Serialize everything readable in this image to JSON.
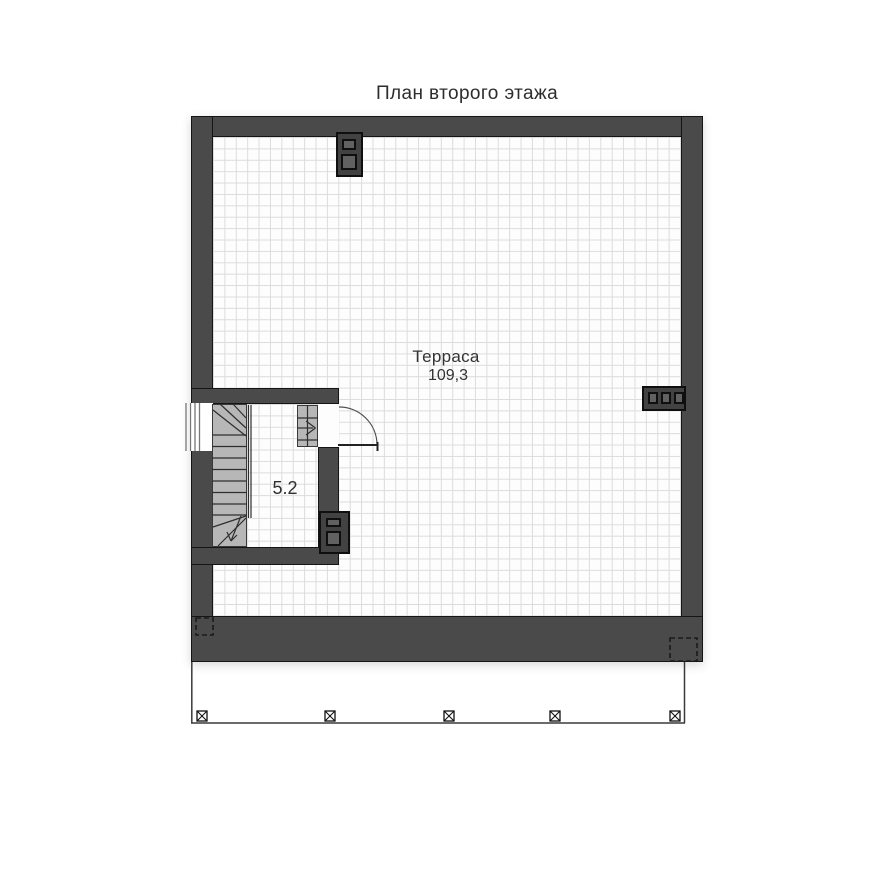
{
  "page": {
    "title": "План второго этажа"
  },
  "rooms": {
    "terrace": {
      "name": "Терраса",
      "area": "109,3"
    },
    "stairwell": {
      "area": "5.2"
    }
  },
  "symbols": [
    "chimney-flue-icon",
    "wall-vent-icon",
    "stair-flue-icon",
    "door-swing-icon",
    "stair-up-arrow-icon",
    "stair-down-arrow-icon",
    "window-icon",
    "column-marker-icon",
    "shaft-dashed-outline"
  ],
  "colors": {
    "wall": "#4a4a4a",
    "outline": "#151515",
    "grid_line": "#dcdcdc",
    "floor": "#fdfdfd",
    "stair_fill": "#b7b7b7",
    "line_dark": "#2e2e2e",
    "text": "#333333",
    "background": "#ffffff",
    "block": "#424242",
    "block_inner": "#616161"
  }
}
